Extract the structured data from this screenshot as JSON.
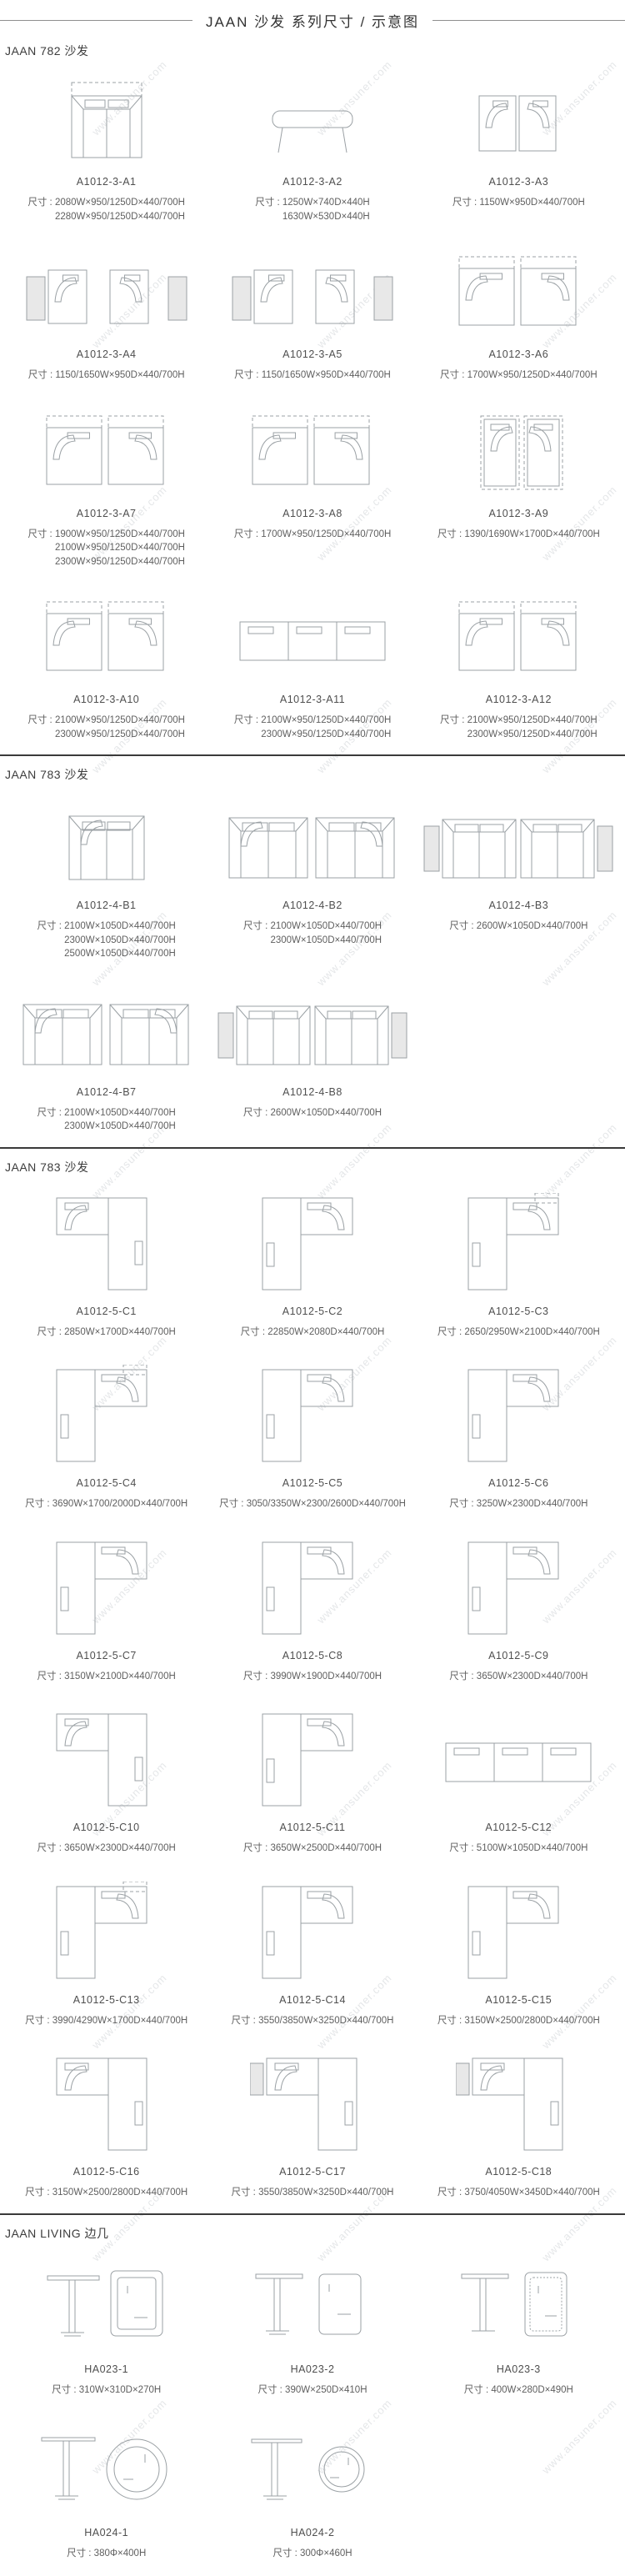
{
  "page": {
    "title": "JAAN  沙发 系列尺寸 / 示意图",
    "watermark": "www.ansuner.com",
    "dim_prefix": "尺寸 : "
  },
  "sections": [
    {
      "title": "JAAN 782 沙发",
      "rows": [
        [
          {
            "model": "A1012-3-A1",
            "icon": "sofa-top",
            "dims": [
              "2080W×950/1250D×440/700H",
              "2280W×950/1250D×440/700H"
            ]
          },
          {
            "model": "A1012-3-A2",
            "icon": "ottoman",
            "dims": [
              "1250W×740D×440H",
              "1630W×530D×440H"
            ]
          },
          {
            "model": "A1012-3-A3",
            "icon": "module-pair",
            "dims": [
              "1150W×950D×440/700H"
            ]
          }
        ],
        [
          {
            "model": "A1012-3-A4",
            "icon": "module-pair-table",
            "dims": [
              "1150/1650W×950D×440/700H"
            ]
          },
          {
            "model": "A1012-3-A5",
            "icon": "module-pair-table",
            "dims": [
              "1150/1650W×950D×440/700H"
            ]
          },
          {
            "model": "A1012-3-A6",
            "icon": "module-pair-dashed",
            "dims": [
              "1700W×950/1250D×440/700H"
            ]
          }
        ],
        [
          {
            "model": "A1012-3-A7",
            "icon": "module-pair-dashed",
            "dims": [
              "1900W×950/1250D×440/700H",
              "2100W×950/1250D×440/700H",
              "2300W×950/1250D×440/700H"
            ]
          },
          {
            "model": "A1012-3-A8",
            "icon": "module-pair-dashed",
            "dims": [
              "1700W×950/1250D×440/700H"
            ]
          },
          {
            "model": "A1012-3-A9",
            "icon": "chaise-pair",
            "dims": [
              "1390/1690W×1700D×440/700H"
            ]
          }
        ],
        [
          {
            "model": "A1012-3-A10",
            "icon": "module-pair-dashed",
            "dims": [
              "2100W×950/1250D×440/700H",
              "2300W×950/1250D×440/700H"
            ]
          },
          {
            "model": "A1012-3-A11",
            "icon": "sofa-long",
            "dims": [
              "2100W×950/1250D×440/700H",
              "2300W×950/1250D×440/700H"
            ]
          },
          {
            "model": "A1012-3-A12",
            "icon": "module-pair-dashed",
            "dims": [
              "2100W×950/1250D×440/700H",
              "2300W×950/1250D×440/700H"
            ]
          }
        ]
      ]
    },
    {
      "title": "JAAN 783 沙发",
      "rows": [
        [
          {
            "model": "A1012-4-B1",
            "icon": "sofa-2seat",
            "dims": [
              "2100W×1050D×440/700H",
              "2300W×1050D×440/700H",
              "2500W×1050D×440/700H"
            ]
          },
          {
            "model": "A1012-4-B2",
            "icon": "sofa-pair",
            "dims": [
              "2100W×1050D×440/700H",
              "2300W×1050D×440/700H"
            ]
          },
          {
            "model": "A1012-4-B3",
            "icon": "sofa-pair-table",
            "dims": [
              "2600W×1050D×440/700H"
            ]
          }
        ],
        [
          {
            "model": "A1012-4-B7",
            "icon": "sofa-pair",
            "dims": [
              "2100W×1050D×440/700H",
              "2300W×1050D×440/700H"
            ]
          },
          {
            "model": "A1012-4-B8",
            "icon": "sofa-pair-table",
            "dims": [
              "2600W×1050D×440/700H"
            ]
          }
        ]
      ]
    },
    {
      "title": "JAAN 783 沙发",
      "rows": [
        [
          {
            "model": "A1012-5-C1",
            "icon": "lshape-right",
            "dims": [
              "2850W×1700D×440/700H"
            ]
          },
          {
            "model": "A1012-5-C2",
            "icon": "lshape-left",
            "dims": [
              "22850W×2080D×440/700H"
            ]
          },
          {
            "model": "A1012-5-C3",
            "icon": "lshape-dashed",
            "dims": [
              "2650/2950W×2100D×440/700H"
            ]
          }
        ],
        [
          {
            "model": "A1012-5-C4",
            "icon": "lshape-dashed",
            "dims": [
              "3690W×1700/2000D×440/700H"
            ]
          },
          {
            "model": "A1012-5-C5",
            "icon": "lshape-left",
            "dims": [
              "3050/3350W×2300/2600D×440/700H"
            ]
          },
          {
            "model": "A1012-5-C6",
            "icon": "lshape-left",
            "dims": [
              "3250W×2300D×440/700H"
            ]
          }
        ],
        [
          {
            "model": "A1012-5-C7",
            "icon": "lshape-left",
            "dims": [
              "3150W×2100D×440/700H"
            ]
          },
          {
            "model": "A1012-5-C8",
            "icon": "lshape-left",
            "dims": [
              "3990W×1900D×440/700H"
            ]
          },
          {
            "model": "A1012-5-C9",
            "icon": "lshape-left",
            "dims": [
              "3650W×2300D×440/700H"
            ]
          }
        ],
        [
          {
            "model": "A1012-5-C10",
            "icon": "lshape-right",
            "dims": [
              "3650W×2300D×440/700H"
            ]
          },
          {
            "model": "A1012-5-C11",
            "icon": "lshape-left",
            "dims": [
              "3650W×2500D×440/700H"
            ]
          },
          {
            "model": "A1012-5-C12",
            "icon": "sofa-long",
            "dims": [
              "5100W×1050D×440/700H"
            ]
          }
        ],
        [
          {
            "model": "A1012-5-C13",
            "icon": "lshape-dashed",
            "dims": [
              "3990/4290W×1700D×440/700H"
            ]
          },
          {
            "model": "A1012-5-C14",
            "icon": "lshape-left",
            "dims": [
              "3550/3850W×3250D×440/700H"
            ]
          },
          {
            "model": "A1012-5-C15",
            "icon": "lshape-left",
            "dims": [
              "3150W×2500/2800D×440/700H"
            ]
          }
        ],
        [
          {
            "model": "A1012-5-C16",
            "icon": "lshape-right",
            "dims": [
              "3150W×2500/2800D×440/700H"
            ]
          },
          {
            "model": "A1012-5-C17",
            "icon": "lshape-table",
            "dims": [
              "3550/3850W×3250D×440/700H"
            ]
          },
          {
            "model": "A1012-5-C18",
            "icon": "lshape-table",
            "dims": [
              "3750/4050W×3450D×440/700H"
            ]
          }
        ]
      ]
    },
    {
      "title": "JAAN LIVING 边几",
      "rows": [
        [
          {
            "model": "HA023-1",
            "icon": "side-table-square",
            "dims": [
              "310W×310D×270H"
            ]
          },
          {
            "model": "HA023-2",
            "icon": "side-table-portrait",
            "dims": [
              "390W×250D×410H"
            ]
          },
          {
            "model": "HA023-3",
            "icon": "side-table-dotted",
            "dims": [
              "400W×280D×490H"
            ]
          }
        ],
        [
          {
            "model": "HA024-1",
            "icon": "round-table-large",
            "dims": [
              "380Φ×400H"
            ]
          },
          {
            "model": "HA024-2",
            "icon": "round-table-small",
            "dims": [
              "300Φ×460H"
            ]
          }
        ]
      ]
    }
  ]
}
